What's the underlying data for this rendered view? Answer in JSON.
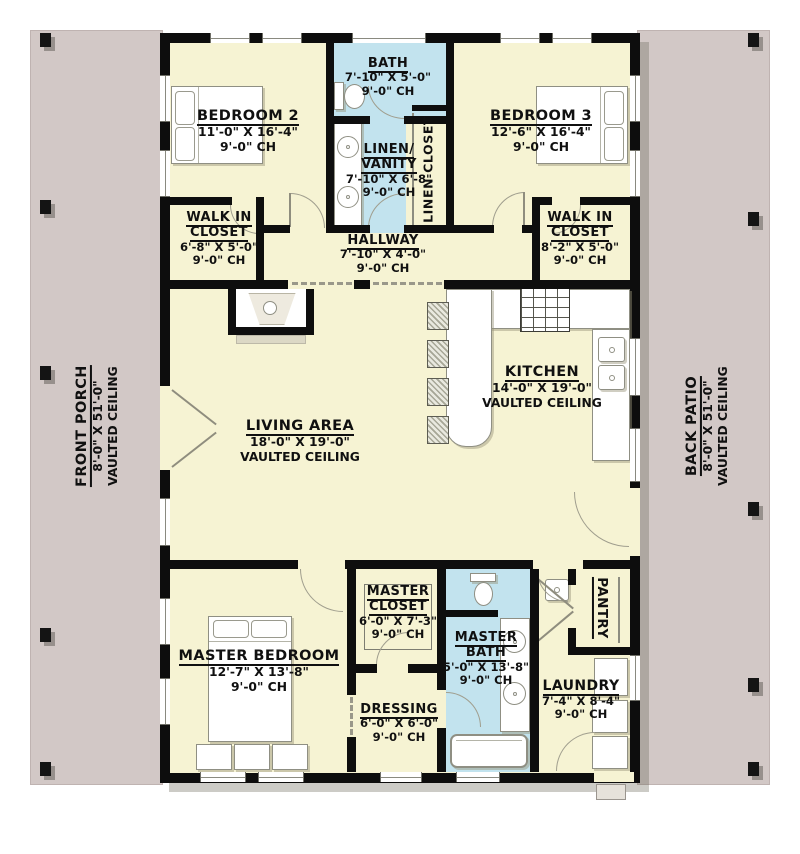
{
  "plan_colors": {
    "floor": "#f6f3d3",
    "bath_floor": "#c2e3ee",
    "porch": "#d2c8c6",
    "wall": "#0e0e0e"
  },
  "rooms": {
    "front_porch": {
      "name": "FRONT PORCH",
      "dims": "8'-0\" X 51'-0\"",
      "ch": "VAULTED CEILING"
    },
    "back_patio": {
      "name": "BACK PATIO",
      "dims": "8'-0\" X 51'-0\"",
      "ch": "VAULTED CEILING"
    },
    "bedroom2": {
      "name": "BEDROOM 2",
      "dims": "11'-0\" X 16'-4\"",
      "ch": "9'-0\" CH"
    },
    "bath": {
      "name": "BATH",
      "dims": "7'-10\" X 5'-0\"",
      "ch": "9'-0\" CH"
    },
    "linen_vanity": {
      "name1": "LINEN/",
      "name2": "VANITY",
      "dims": "7'-10\" X 6'-8\"",
      "ch": "9'-0\" CH"
    },
    "linen_closet": {
      "name": "LINEN CLOSET"
    },
    "bedroom3": {
      "name": "BEDROOM 3",
      "dims": "12'-6\" X 16'-4\"",
      "ch": "9'-0\" CH"
    },
    "wic_left": {
      "name1": "WALK IN",
      "name2": "CLOSET",
      "dims": "6'-8\" X 5'-0\"",
      "ch": "9'-0\" CH"
    },
    "hallway": {
      "name": "HALLWAY",
      "dims": "7'-10\" X 4'-0\"",
      "ch": "9'-0\" CH"
    },
    "wic_right": {
      "name1": "WALK IN",
      "name2": "CLOSET",
      "dims": "8'-2\" X 5'-0\"",
      "ch": "9'-0\" CH"
    },
    "living": {
      "name": "LIVING AREA",
      "dims": "18'-0\" X 19'-0\"",
      "ch": "VAULTED CEILING"
    },
    "kitchen": {
      "name": "KITCHEN",
      "dims": "14'-0\" X 19'-0\"",
      "ch": "VAULTED CEILING"
    },
    "master_bedroom": {
      "name": "MASTER BEDROOM",
      "dims": "12'-7\" X 13'-8\"",
      "ch": "9'-0\" CH"
    },
    "master_closet": {
      "name1": "MASTER",
      "name2": "CLOSET",
      "dims": "6'-0\" X 7'-3\"",
      "ch": "9'-0\" CH"
    },
    "dressing": {
      "name": "DRESSING",
      "dims": "6'-0\" X 6'-0\"",
      "ch": "9'-0\" CH"
    },
    "master_bath": {
      "name1": "MASTER",
      "name2": "BATH",
      "dims": "5'-0\" X 13'-8\"",
      "ch": "9'-0\" CH"
    },
    "pantry": {
      "name": "PANTRY"
    },
    "laundry": {
      "name": "LAUNDRY",
      "dims": "7'-4\" X 8'-4\"",
      "ch": "9'-0\" CH"
    }
  }
}
